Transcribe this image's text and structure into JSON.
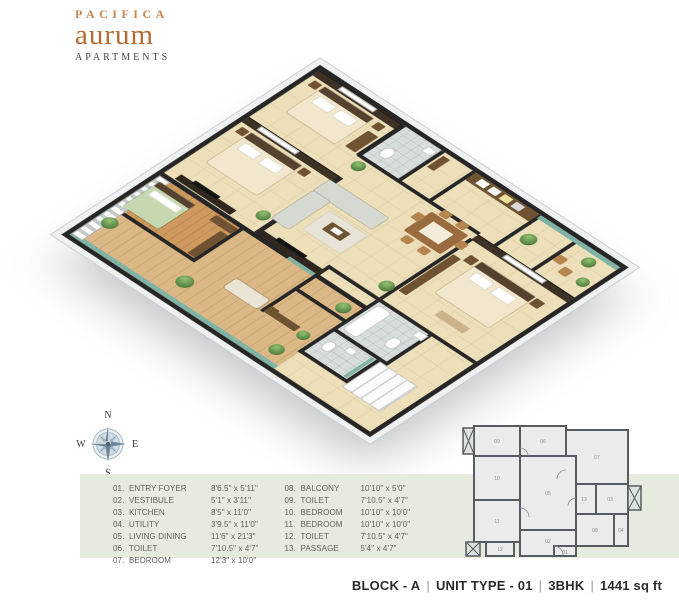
{
  "brand": {
    "line1": "PACIFICA",
    "line2": "aurum",
    "line3": "APARTMENTS"
  },
  "compass": {
    "n": "N",
    "e": "E",
    "s": "S",
    "w": "W"
  },
  "legend": {
    "items": [
      {
        "num": "01.",
        "name": "ENTRY FOYER",
        "dims": "8'6.5\" x 5'11\""
      },
      {
        "num": "02.",
        "name": "VESTIBULE",
        "dims": "5'1\" x 3'11\""
      },
      {
        "num": "03.",
        "name": "KITCHEN",
        "dims": "8'5\" x 11'0\""
      },
      {
        "num": "04.",
        "name": "UTILITY",
        "dims": "3'9.5\" x 11'0\""
      },
      {
        "num": "05.",
        "name": "LIVING DINING",
        "dims": "11'6\" x 21'3\""
      },
      {
        "num": "06.",
        "name": "TOILET",
        "dims": "7'10.5\" x 4'7\""
      },
      {
        "num": "07.",
        "name": "BEDROOM",
        "dims": "12'3\" x 10'0\""
      },
      {
        "num": "08.",
        "name": "BALCONY",
        "dims": "10'10\" x 5'0\""
      },
      {
        "num": "09.",
        "name": "TOILET",
        "dims": "7'10.5\" x 4'7\""
      },
      {
        "num": "10.",
        "name": "BEDROOM",
        "dims": "10'10\" x 10'0\""
      },
      {
        "num": "11.",
        "name": "BEDROOM",
        "dims": "10'10\" x 10'0\""
      },
      {
        "num": "12.",
        "name": "TOILET",
        "dims": "7'10.5\" x 4'7\""
      },
      {
        "num": "13.",
        "name": "PASSAGE",
        "dims": "5'4\" x 4'7\""
      }
    ]
  },
  "miniplan": {
    "labels": [
      "09",
      "06",
      "07",
      "10",
      "05",
      "13",
      "03",
      "08",
      "04",
      "11",
      "12",
      "02",
      "01"
    ]
  },
  "footer": {
    "block": "BLOCK - A",
    "unit_type": "UNIT TYPE - 01",
    "bhk": "3BHK",
    "area": "1441 sq ft",
    "separator": "|"
  },
  "colors": {
    "brand_orange": "#b56b34",
    "brand_dark": "#474747",
    "legend_bg": "#e6ecdd",
    "legend_text": "#5d625e",
    "wall_dark": "#262626",
    "floor_beige": "#ecdfb9",
    "glass_teal": "#7fb3a5",
    "wood_dark": "#3e3126",
    "plant_green": "#5c8a46",
    "footer_text": "#2b2b2b"
  }
}
